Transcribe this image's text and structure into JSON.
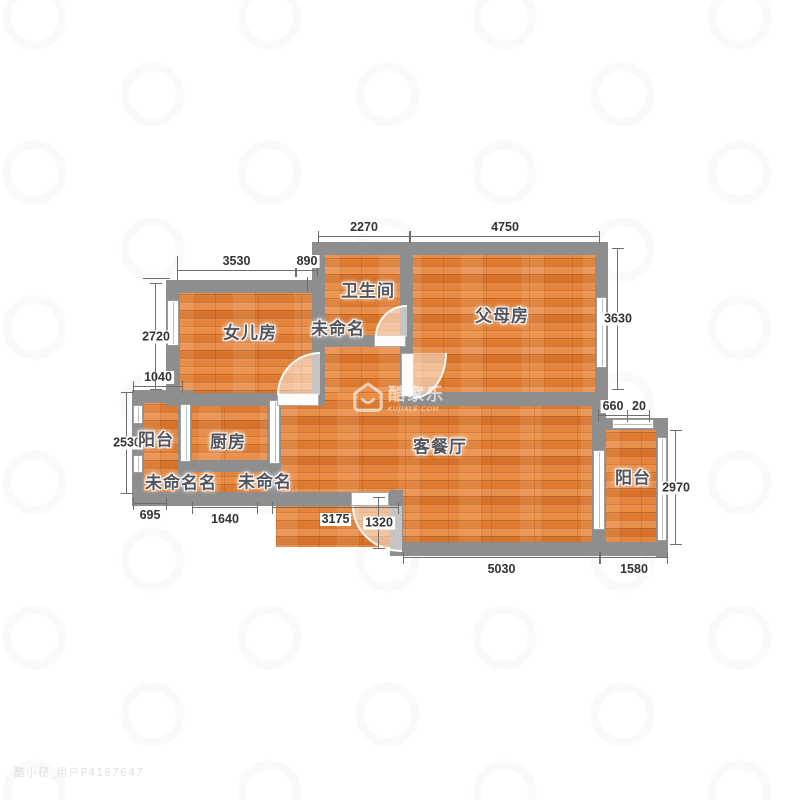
{
  "watermark_center": {
    "brand": "酷家乐",
    "domain": "KUJIALE.COM"
  },
  "watermark_corner": "酷小秘_用户P4187647",
  "rooms": {
    "bathroom": "卫生间",
    "hallway_unnamed": "未命名",
    "daughter_room": "女儿房",
    "parents_room": "父母房",
    "balcony_left": "阳台",
    "kitchen": "厨房",
    "living_dining": "客餐厅",
    "balcony_right": "阳台",
    "unnamed_left": "未命名名",
    "unnamed_middle": "未命名"
  },
  "dimensions_mm": {
    "bath_top_width": "2270",
    "parents_width": "4750",
    "daughter_width": "3530",
    "bath_left_offset": "890",
    "daughter_height": "2720",
    "balcony_left_top": "1040",
    "balcony_left_height": "2530",
    "parents_height": "3630",
    "right_step_a": "660",
    "right_step_b": "20",
    "balcony_right_height": "2970",
    "corner_left": "695",
    "corridor_bottom": "1640",
    "living_lower_left": "3175",
    "entry_step": "1320",
    "living_bottom": "5030",
    "balcony_right_bottom": "1580"
  },
  "colors": {
    "wall": "#8e8e8e",
    "floor_base": "#e28136",
    "dimension_text": "#333333",
    "room_label_text": "#54545c"
  }
}
